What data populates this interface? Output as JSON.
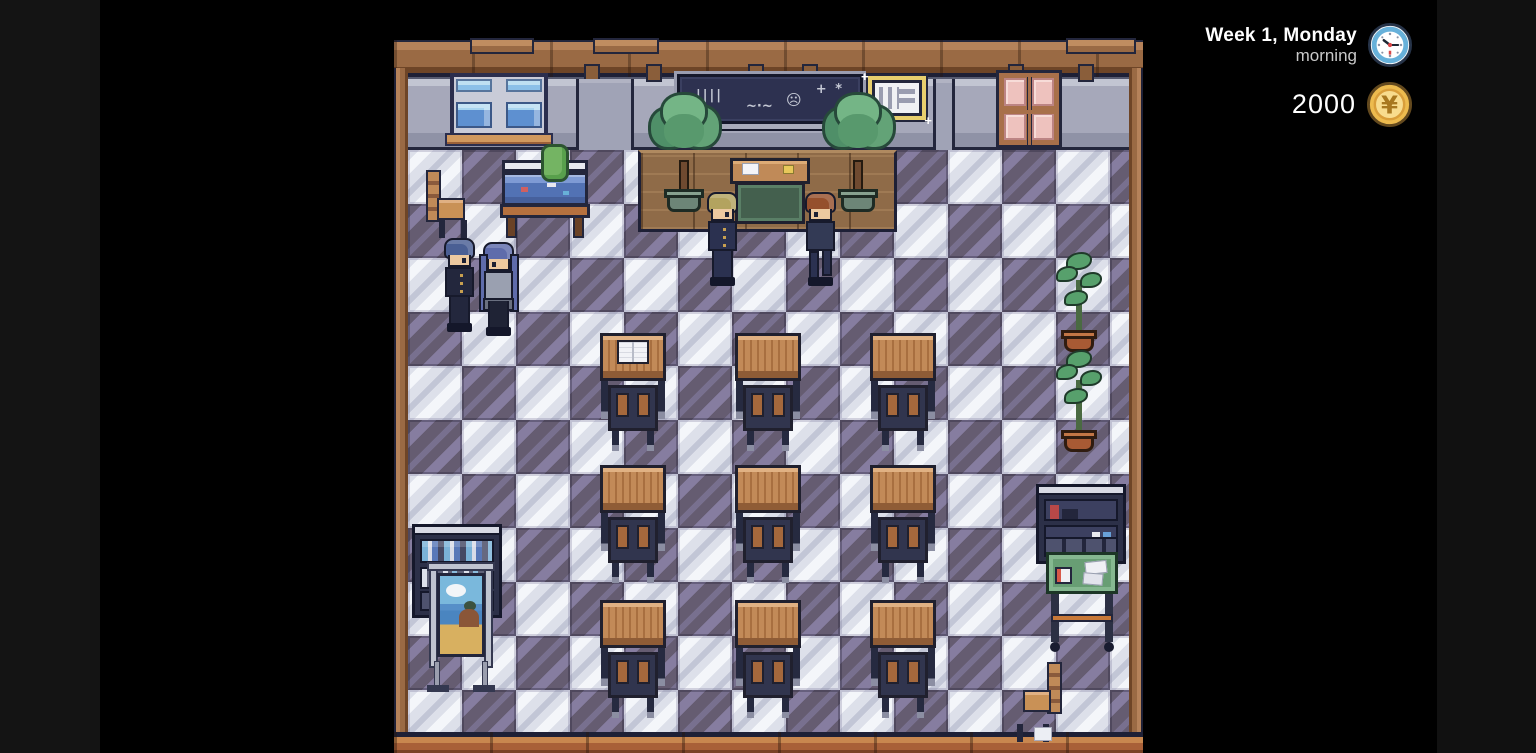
{
  "hud": {
    "date_label": "Week 1, Monday",
    "time_label": "morning",
    "money": "2000",
    "coin_symbol": "¥",
    "colors": {
      "date_text": "#ffffff",
      "time_text": "#c9c9c9",
      "money_text": "#ffffff",
      "clock_ring": "#67b1da",
      "clock_face": "#ffffff",
      "clock_hands": "#1d2733",
      "clock_accent": "#d84848",
      "coin_fill": "#edbb4e",
      "coin_inner": "#f8dc8e",
      "coin_symbol_color": "#a87820"
    }
  },
  "scene": {
    "label": "classroom",
    "viewport": {
      "x": 394,
      "y": 40,
      "w": 749,
      "h": 713
    },
    "background": {
      "stage": "#000000",
      "left_strip": "#141414",
      "right_strip": "#111111"
    },
    "palette": {
      "wood_trim": "#9a6a44",
      "wall": "#a6a8ba",
      "wall_lower": "#8f92a6",
      "outline": "#1e2036"
    },
    "floor": {
      "origin_x": 408,
      "origin_y": 150,
      "tile": 54,
      "cols": 14,
      "rows": 11,
      "dark": "#655c71",
      "dark_stripe": "#867da0",
      "light": "#dde0ea",
      "light_stripe": "#f4f6fa",
      "parity": "light_when_col_plus_row_even"
    },
    "chalk_doodles": {
      "tally": "||||",
      "squiggle": "~·~",
      "face": "☹",
      "sparkle": "+ *"
    },
    "entities": [
      {
        "kind": "trim-plank",
        "name": "trim-plank",
        "x": 470,
        "y": 38,
        "w": 64,
        "h": 16
      },
      {
        "kind": "trim-plank",
        "name": "trim-plank",
        "x": 593,
        "y": 38,
        "w": 66,
        "h": 16
      },
      {
        "kind": "trim-plank",
        "name": "trim-plank",
        "x": 1066,
        "y": 38,
        "w": 70,
        "h": 16
      },
      {
        "kind": "trim-post",
        "name": "trim-post",
        "x": 584,
        "y": 64,
        "w": 16,
        "h": 18
      },
      {
        "kind": "trim-post",
        "name": "trim-post",
        "x": 646,
        "y": 64,
        "w": 16,
        "h": 18
      },
      {
        "kind": "trim-post",
        "name": "trim-post",
        "x": 748,
        "y": 64,
        "w": 16,
        "h": 18
      },
      {
        "kind": "trim-post",
        "name": "trim-post",
        "x": 802,
        "y": 64,
        "w": 16,
        "h": 18
      },
      {
        "kind": "trim-post",
        "name": "trim-post",
        "x": 1008,
        "y": 64,
        "w": 16,
        "h": 18
      },
      {
        "kind": "trim-post",
        "name": "trim-post",
        "x": 1078,
        "y": 64,
        "w": 16,
        "h": 18
      },
      {
        "kind": "pillar",
        "name": "wall-pillar-left",
        "x": 576,
        "y": 79,
        "w": 58,
        "h": 71
      },
      {
        "kind": "pillar",
        "name": "wall-pillar-right",
        "x": 933,
        "y": 79,
        "w": 22,
        "h": 71
      },
      {
        "kind": "window",
        "name": "window",
        "x": 450,
        "y": 73,
        "w": 98,
        "h": 64
      },
      {
        "kind": "chalkboard",
        "name": "chalkboard",
        "x": 677,
        "y": 74,
        "w": 186,
        "h": 50
      },
      {
        "kind": "noticeboard",
        "name": "notice-board",
        "x": 872,
        "y": 80,
        "w": 50,
        "h": 36
      },
      {
        "kind": "door",
        "name": "classroom-door",
        "x": 996,
        "y": 70,
        "w": 66,
        "h": 78,
        "interactable": true
      },
      {
        "kind": "platform",
        "name": "teacher-platform",
        "x": 638,
        "y": 150,
        "w": 259,
        "h": 82
      },
      {
        "kind": "tree",
        "name": "potted-tree-left",
        "x": 646,
        "y": 92,
        "w": 76,
        "h": 120
      },
      {
        "kind": "tree",
        "name": "potted-tree-right",
        "x": 820,
        "y": 92,
        "w": 76,
        "h": 120
      },
      {
        "kind": "teacher-desk",
        "name": "teacher-desk",
        "x": 730,
        "y": 158,
        "w": 80,
        "h": 70
      },
      {
        "kind": "aquarium",
        "name": "aquarium-stand",
        "x": 500,
        "y": 160,
        "w": 90,
        "h": 78
      },
      {
        "kind": "cactus",
        "name": "cactus-pot",
        "x": 541,
        "y": 144,
        "w": 28,
        "h": 38
      },
      {
        "kind": "side-chair",
        "name": "chair-northwest",
        "x": 424,
        "y": 170,
        "w": 44,
        "h": 68
      },
      {
        "kind": "character",
        "name": "student-blue-hair",
        "x": 440,
        "y": 238,
        "w": 40,
        "h": 96,
        "interactable": true,
        "props": {
          "hair": "#4a5f94",
          "outfit": "#23273d",
          "pants": "#23273d",
          "facing": "right",
          "buttons": true
        }
      },
      {
        "kind": "character",
        "name": "student-purple-hair-girl",
        "x": 479,
        "y": 242,
        "w": 40,
        "h": 96,
        "interactable": true,
        "props": {
          "girl": true,
          "hair": "#5f6cab",
          "outfit": "#9aa0b0",
          "skirt": "#6a7080",
          "pants": "#1f2335",
          "facing": "left"
        }
      },
      {
        "kind": "character",
        "name": "student-blonde",
        "x": 703,
        "y": 192,
        "w": 40,
        "h": 96,
        "interactable": true,
        "props": {
          "hair": "#b3a35f",
          "outfit": "#2b3150",
          "pants": "#2b3150",
          "facing": "right",
          "buttons": true
        }
      },
      {
        "kind": "character",
        "name": "student-auburn",
        "x": 801,
        "y": 192,
        "w": 40,
        "h": 96,
        "interactable": true,
        "props": {
          "hair": "#95502d",
          "outfit": "#333a55",
          "pants": "#2b3150",
          "facing": "left",
          "stride": true
        }
      },
      {
        "kind": "desk",
        "name": "student-desk-r1c1",
        "x": 600,
        "y": 333,
        "w": 66,
        "h": 118,
        "props": {
          "book": true
        }
      },
      {
        "kind": "desk",
        "name": "student-desk-r1c2",
        "x": 735,
        "y": 333,
        "w": 66,
        "h": 118
      },
      {
        "kind": "desk",
        "name": "student-desk-r1c3",
        "x": 870,
        "y": 333,
        "w": 66,
        "h": 118
      },
      {
        "kind": "desk",
        "name": "student-desk-r2c1",
        "x": 600,
        "y": 465,
        "w": 66,
        "h": 118
      },
      {
        "kind": "desk",
        "name": "student-desk-r2c2",
        "x": 735,
        "y": 465,
        "w": 66,
        "h": 118
      },
      {
        "kind": "desk",
        "name": "student-desk-r2c3",
        "x": 870,
        "y": 465,
        "w": 66,
        "h": 118
      },
      {
        "kind": "desk",
        "name": "student-desk-r3c1",
        "x": 600,
        "y": 600,
        "w": 66,
        "h": 118
      },
      {
        "kind": "desk",
        "name": "student-desk-r3c2",
        "x": 735,
        "y": 600,
        "w": 66,
        "h": 118
      },
      {
        "kind": "desk",
        "name": "student-desk-r3c3",
        "x": 870,
        "y": 600,
        "w": 66,
        "h": 118
      },
      {
        "kind": "plant",
        "name": "potted-plant-upper",
        "x": 1056,
        "y": 252,
        "w": 46,
        "h": 100
      },
      {
        "kind": "plant",
        "name": "potted-plant-lower",
        "x": 1056,
        "y": 350,
        "w": 46,
        "h": 102
      },
      {
        "kind": "bookshelf",
        "name": "bookshelf-southwest",
        "x": 412,
        "y": 524,
        "w": 90,
        "h": 94
      },
      {
        "kind": "easel",
        "name": "poster-easel",
        "x": 427,
        "y": 562,
        "w": 68,
        "h": 130
      },
      {
        "kind": "shelf",
        "name": "shelf-southeast",
        "x": 1036,
        "y": 484,
        "w": 90,
        "h": 80
      },
      {
        "kind": "cart",
        "name": "supply-cart",
        "x": 1046,
        "y": 552,
        "w": 72,
        "h": 102
      },
      {
        "kind": "side-chair",
        "name": "chair-southeast",
        "x": 1016,
        "y": 662,
        "w": 48,
        "h": 80,
        "props": {
          "flip": true,
          "paper": true
        }
      }
    ]
  }
}
